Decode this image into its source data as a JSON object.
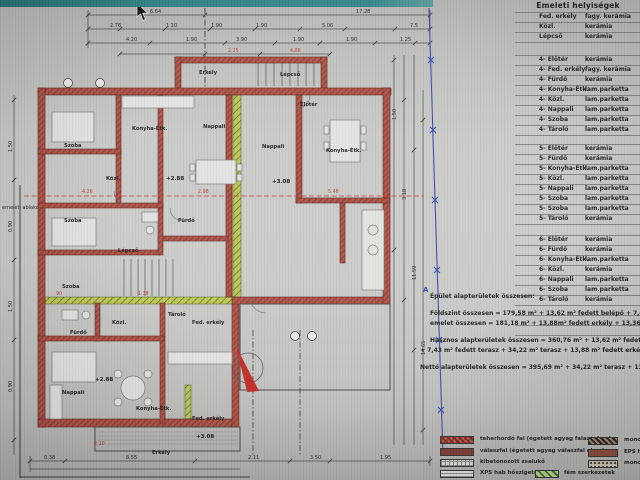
{
  "colors": {
    "wall_red": "#a84a3c",
    "strip_green": "#bcc653",
    "boundary_blue": "#3448b0",
    "north_red": "#c0281e",
    "topbar_teal": "#2f8486"
  },
  "plan": {
    "left_note": "emeleti ablakok",
    "boundary_label": "A",
    "rooms": [
      "Erkély",
      "Lépcső",
      "Szoba",
      "Konyha-Étk.",
      "Nappali",
      "Nappali",
      "Konyha-Étk.",
      "Közl.",
      "Szoba",
      "Fürdő",
      "Lépcső",
      "Szoba",
      "Előtér",
      "Fürdő",
      "Közl.",
      "Tároló",
      "Nappali",
      "Konyha-Étk.",
      "Fed. erkély",
      "Fed. erkély",
      "Erkély"
    ],
    "levels": [
      "+2.88",
      "+3.08",
      "+2.88",
      "+3.08"
    ],
    "dims_top1": [
      "6.64",
      "17.28"
    ],
    "dims_top2": [
      "2.76",
      "1.10",
      "1.90",
      "1.90",
      "5.06",
      "7.5"
    ],
    "dims_top3": [
      "4.20",
      "1.90",
      "3.90",
      "1.90",
      "1.90",
      "1.25"
    ],
    "dims_top_red": [
      "2.25",
      "4.86"
    ],
    "dims_bottom": [
      "0.38",
      "8.55",
      "2.11",
      "3.50",
      "1.95"
    ],
    "dims_right": [
      "1.50",
      "3.18",
      "11.59",
      "14.65"
    ],
    "dims_left": [
      "1.50",
      "0.90",
      "1.50",
      "0.90"
    ],
    "dims_red": [
      "4.26",
      "2.98",
      "5.48",
      "90",
      "1.38",
      "2.10"
    ]
  },
  "table": {
    "title": "Emeleti helyiségek",
    "s0": [
      {
        "n": "Fed. erkély",
        "m": "fagy. kerámia"
      },
      {
        "n": "Közl.",
        "m": "kerámia"
      },
      {
        "n": "Lépcső",
        "m": "kerámia"
      }
    ],
    "s1": [
      {
        "n": "4- Előtér",
        "m": "kerámia"
      },
      {
        "n": "4- Fed. erkély",
        "m": "fagy. kerámia"
      },
      {
        "n": "4- Fürdő",
        "m": "kerámia"
      },
      {
        "n": "4- Konyha-Étk.",
        "m": "lam.parketta"
      },
      {
        "n": "4- Közl.",
        "m": "lam.parketta"
      },
      {
        "n": "4- Nappali",
        "m": "lam.parketta"
      },
      {
        "n": "4- Szoba",
        "m": "lam.parketta"
      },
      {
        "n": "4- Tároló",
        "m": "lam.parketta"
      }
    ],
    "s2": [
      {
        "n": "5- Előtér",
        "m": "kerámia"
      },
      {
        "n": "5- Fürdő",
        "m": "kerámia"
      },
      {
        "n": "5- Konyha-Étk.",
        "m": "lam.parketta"
      },
      {
        "n": "5- Közl.",
        "m": "lam.parketta"
      },
      {
        "n": "5- Nappali",
        "m": "lam.parketta"
      },
      {
        "n": "5- Szoba",
        "m": "lam.parketta"
      },
      {
        "n": "5- Szoba",
        "m": "lam.parketta"
      },
      {
        "n": "5- Tároló",
        "m": "kerámia"
      }
    ],
    "s3": [
      {
        "n": "6- Előtér",
        "m": "kerámia"
      },
      {
        "n": "6- Fürdő",
        "m": "kerámia"
      },
      {
        "n": "6- Konyha-Étk.",
        "m": "lam.parketta"
      },
      {
        "n": "6- Közl.",
        "m": "kerámia"
      },
      {
        "n": "6- Nappali",
        "m": "lam.parketta"
      },
      {
        "n": "6- Szoba",
        "m": "lam.parketta"
      },
      {
        "n": "6- Tároló",
        "m": "kerámia"
      }
    ]
  },
  "summary": {
    "title": "Épület alapterületek összesen:",
    "l1": "Földszint összesen = 179,58 m²  + 13,62 m² fedett belépő + 7,43 m² fedett terasz + 34",
    "l2": "emelet összesen = 181,18 m²  + 13,88m² fedett erkély + 13,36 m² erkély",
    "l3": "Hasznos alapterületek összesen = 360,76 m² + 13,62 m² fedett belépő",
    "l4": "+ 7,43 m² fedett terasz + 34,22 m² terasz + 13,88 m² fedett erkély + 13,3",
    "l5": "Nettó alapterületek összesen = 395,69 m² + 34,22 m² terasz + 13,36 m² e"
  },
  "legend": {
    "l1": "teherhordó fal (égetett agyag falazóelem)",
    "l2": "válaszfal (égetett agyag válaszfal elem)",
    "l3": "kibetonozott zsalukő",
    "l4": "XPS hab hőszigetelés",
    "l5": "fém szerkezetek",
    "r1": "mono",
    "r2": "EPS h",
    "r3": "mono"
  }
}
